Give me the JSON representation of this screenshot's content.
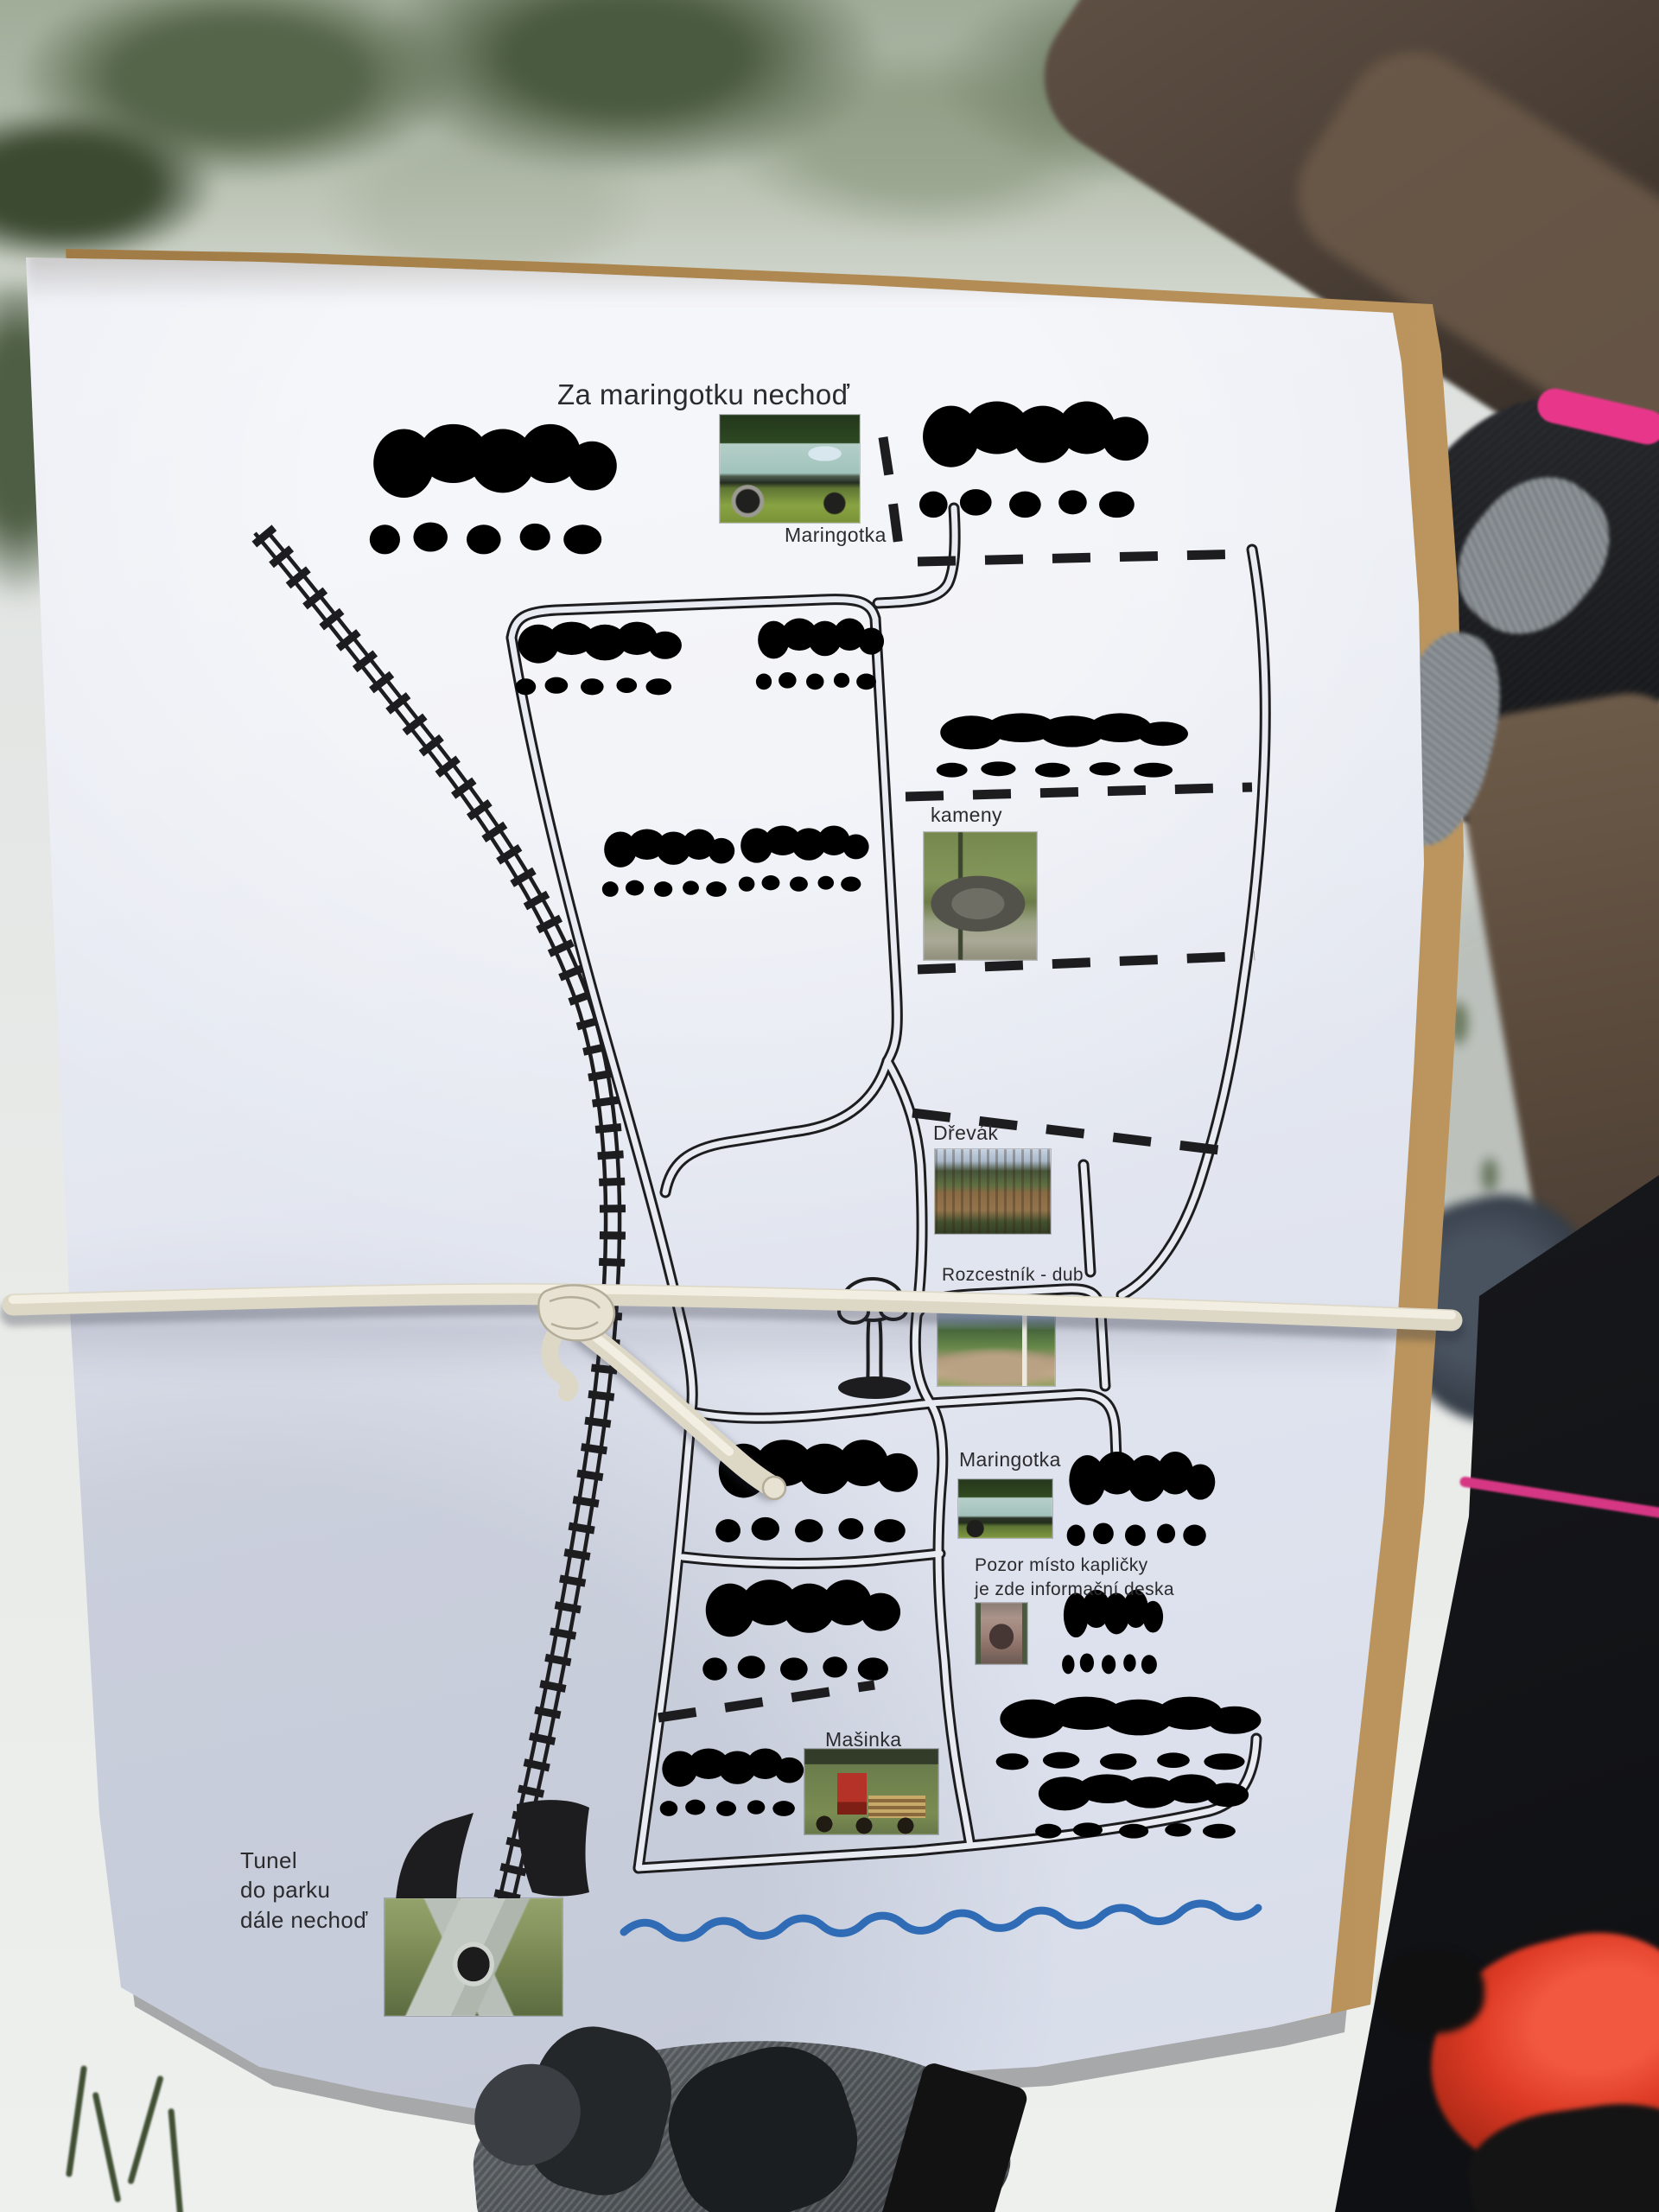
{
  "scene": {
    "kind": "photograph of a hand-drawn park orienteering map on paper, bound with a white elastic cord, held over snowy ground",
    "colors": {
      "paper": "#e6e9f1",
      "ink": "#1d1d1f",
      "river_blue": "#2f6cb5",
      "cord": "#ddd7c6",
      "cardboard": "#b08a52",
      "pink_trim": "#e8378a",
      "red_shoe": "#de3b25"
    }
  },
  "map": {
    "title": "Za maringotku nechoď",
    "captions": {
      "maringotka_top": "Maringotka",
      "kameny": "kameny",
      "drevak": "Dřevák",
      "rozcestnik_dub": "Rozcestník - dub",
      "maringotka_mid": "Maringotka",
      "pozor_l1": "Pozor místo kapličky",
      "pozor_l2": "je zde informační deska",
      "masinka": "Mašinka",
      "tunel_l1": "Tunel",
      "tunel_l2": "do parku",
      "tunel_l3": "dále nechoď"
    },
    "photo_markers": [
      "maringotka-trailer-photo-top",
      "kameny-stones-photo",
      "drevak-fence-photo",
      "rozcestnik-crossroads-photo",
      "maringotka-trailer-photo-mid",
      "kaplicka-chapel-photo",
      "masinka-train-photo",
      "tunel-portal-photo"
    ],
    "symbols": [
      "railway-track",
      "tunnel-portals",
      "solid-footpaths",
      "dashed-boundaries",
      "tree-rows",
      "oak-tree",
      "river-line"
    ]
  }
}
